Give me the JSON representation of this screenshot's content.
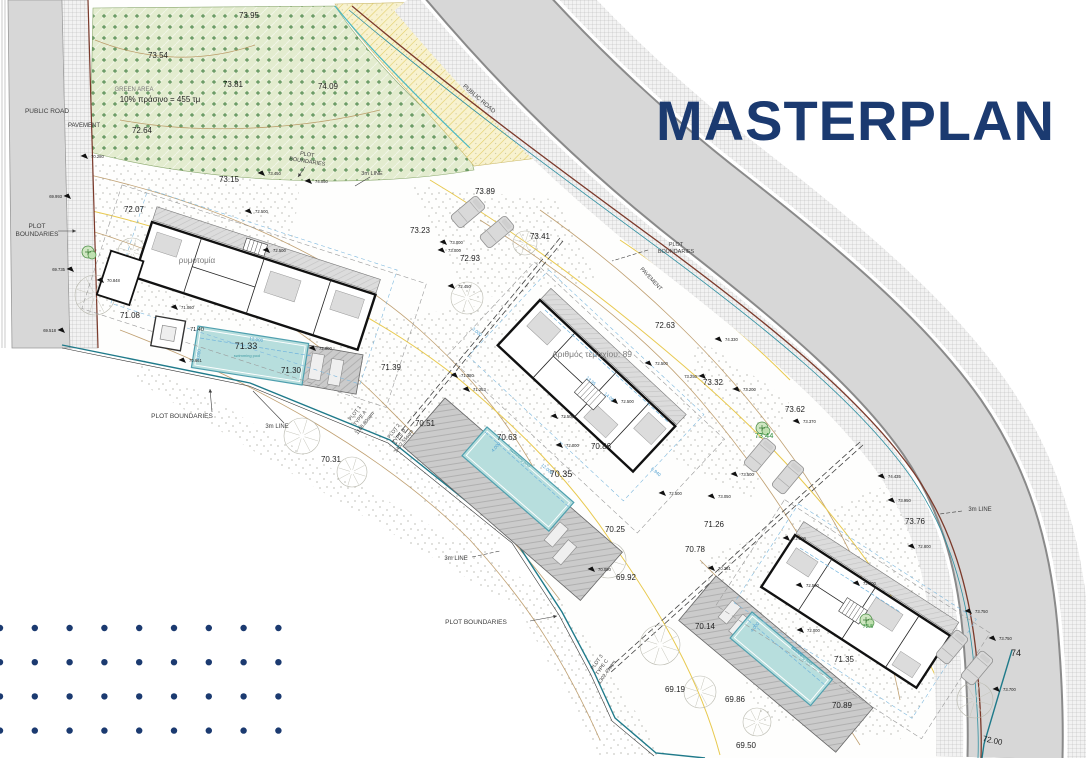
{
  "title": "MASTERPLAN",
  "colors": {
    "accent": "#1b3a70",
    "k": "#1f1f1f",
    "g": "#7a7a7a",
    "c": "#3d3d3d",
    "b": "#4f9fd0",
    "t": "#3f9aa3",
    "gr": "#2f8f3c",
    "pool": "#b7dedd",
    "pool_edge": "#4e9fae",
    "road": "#d7d7d7",
    "boundary_red": "#7b3a2b",
    "boundary_teal": "#2e8fa0",
    "contour_tan": "#b5905a",
    "contour_yellow": "#e8c94f"
  },
  "plan": {
    "labels": [
      {
        "t": "73.95",
        "x": 249,
        "y": 18,
        "s": 8
      },
      {
        "t": "73.54",
        "x": 158,
        "y": 58,
        "s": 8
      },
      {
        "t": "73.81",
        "x": 233,
        "y": 87,
        "s": 8
      },
      {
        "t": "74.09",
        "x": 328,
        "y": 89,
        "s": 8
      },
      {
        "t": "GREEN AREA",
        "x": 134,
        "y": 91,
        "s": 6,
        "c": "g"
      },
      {
        "t": "10% πράσινο = 455 τμ",
        "x": 160,
        "y": 102,
        "s": 8
      },
      {
        "t": "72.64",
        "x": 142,
        "y": 133,
        "s": 8
      },
      {
        "t": "73.15",
        "x": 229,
        "y": 182,
        "s": 8
      },
      {
        "t": "72.07",
        "x": 134,
        "y": 212,
        "s": 8
      },
      {
        "t": "73.89",
        "x": 485,
        "y": 194,
        "s": 8
      },
      {
        "t": "73.23",
        "x": 420,
        "y": 233,
        "s": 8
      },
      {
        "t": "72.93",
        "x": 470,
        "y": 261,
        "s": 8
      },
      {
        "t": "73.41",
        "x": 540,
        "y": 239,
        "s": 8
      },
      {
        "t": "71.08",
        "x": 130,
        "y": 318,
        "s": 8
      },
      {
        "t": "71.33",
        "x": 246,
        "y": 349,
        "s": 9
      },
      {
        "t": "71.30",
        "x": 291,
        "y": 373,
        "s": 8
      },
      {
        "t": "71.39",
        "x": 391,
        "y": 370,
        "s": 8
      },
      {
        "t": "71.40",
        "x": 197,
        "y": 331,
        "s": 5.5
      },
      {
        "t": "70.51",
        "x": 425,
        "y": 426,
        "s": 8
      },
      {
        "t": "70.31",
        "x": 331,
        "y": 462,
        "s": 8
      },
      {
        "t": "70.63",
        "x": 507,
        "y": 440,
        "s": 8
      },
      {
        "t": "70.35",
        "x": 561,
        "y": 477,
        "s": 9
      },
      {
        "t": "70.86",
        "x": 601,
        "y": 449,
        "s": 8
      },
      {
        "t": "70.25",
        "x": 615,
        "y": 532,
        "s": 8
      },
      {
        "t": "72.63",
        "x": 665,
        "y": 328,
        "s": 8
      },
      {
        "t": "73.32",
        "x": 713,
        "y": 385,
        "s": 8
      },
      {
        "t": "73.62",
        "x": 795,
        "y": 412,
        "s": 8
      },
      {
        "t": "73.44",
        "x": 764,
        "y": 438,
        "s": 7.5,
        "c": "gr"
      },
      {
        "t": "72.5",
        "x": 868,
        "y": 628,
        "s": 5.5,
        "c": "gr"
      },
      {
        "t": "71.26",
        "x": 714,
        "y": 527,
        "s": 8
      },
      {
        "t": "70.78",
        "x": 695,
        "y": 552,
        "s": 8
      },
      {
        "t": "69.92",
        "x": 626,
        "y": 580,
        "s": 8
      },
      {
        "t": "70.14",
        "x": 705,
        "y": 629,
        "s": 8
      },
      {
        "t": "69.19",
        "x": 675,
        "y": 692,
        "s": 8
      },
      {
        "t": "69.86",
        "x": 735,
        "y": 702,
        "s": 8
      },
      {
        "t": "69.50",
        "x": 746,
        "y": 748,
        "s": 8
      },
      {
        "t": "73.76",
        "x": 915,
        "y": 524,
        "s": 8
      },
      {
        "t": "71.35",
        "x": 844,
        "y": 662,
        "s": 8
      },
      {
        "t": "70.89",
        "x": 842,
        "y": 708,
        "s": 8
      },
      {
        "t": "74",
        "x": 1016,
        "y": 656,
        "s": 9
      },
      {
        "t": "72.00",
        "x": 992,
        "y": 743,
        "s": 8,
        "r": 12
      },
      {
        "t": "ρυμοτομία",
        "x": 197,
        "y": 263,
        "s": 8,
        "c": "g"
      },
      {
        "t": "Αριθμός τεμαχίου:  89",
        "x": 592,
        "y": 357,
        "s": 8.5,
        "c": "g"
      },
      {
        "t": "PUBLIC ROAD",
        "x": 47,
        "y": 113,
        "s": 6.5,
        "c": "c"
      },
      {
        "t": "PAVEMENT",
        "x": 84,
        "y": 127,
        "s": 6,
        "c": "c"
      },
      {
        "t": "PLOT",
        "x": 37,
        "y": 228,
        "s": 6.5,
        "c": "c"
      },
      {
        "t": "BOUNDARIES",
        "x": 37,
        "y": 236,
        "s": 6.5,
        "c": "c"
      },
      {
        "t": "PUBLIC ROAD",
        "x": 478,
        "y": 100,
        "s": 6,
        "c": "c",
        "r": 41
      },
      {
        "t": "PLOT",
        "x": 676,
        "y": 246,
        "s": 5.5,
        "c": "c"
      },
      {
        "t": "BOUNDARIES",
        "x": 676,
        "y": 253,
        "s": 5.5,
        "c": "c"
      },
      {
        "t": "PAVEMENT",
        "x": 650,
        "y": 280,
        "s": 5.5,
        "c": "c",
        "r": 47
      },
      {
        "t": "3m LINE",
        "x": 372,
        "y": 175,
        "s": 5.5,
        "c": "c"
      },
      {
        "t": "PLOT",
        "x": 307,
        "y": 156,
        "s": 5.5,
        "c": "c",
        "r": 9
      },
      {
        "t": "BOUNDARIES",
        "x": 307,
        "y": 163,
        "s": 5.5,
        "c": "c",
        "r": 9
      },
      {
        "t": "PLOT BOUNDARIES",
        "x": 182,
        "y": 418,
        "s": 6.5,
        "c": "c"
      },
      {
        "t": "3m LINE",
        "x": 277,
        "y": 428,
        "s": 6,
        "c": "c"
      },
      {
        "t": "3m LINE",
        "x": 456,
        "y": 560,
        "s": 6,
        "c": "c"
      },
      {
        "t": "PLOT BOUNDARIES",
        "x": 476,
        "y": 624,
        "s": 6.5,
        "c": "c"
      },
      {
        "t": "3m LINE",
        "x": 980,
        "y": 511,
        "s": 6,
        "c": "c"
      },
      {
        "t": "PLOT 1",
        "x": 356,
        "y": 414,
        "s": 5,
        "c": "c",
        "r": -52
      },
      {
        "t": "TYPE A",
        "x": 361,
        "y": 419,
        "s": 5,
        "c": "c",
        "r": -52
      },
      {
        "t": "1168.80sqm",
        "x": 366,
        "y": 424,
        "s": 5,
        "c": "c",
        "r": -52
      },
      {
        "t": "PLOT 2",
        "x": 395,
        "y": 432,
        "s": 5,
        "c": "c",
        "r": -52
      },
      {
        "t": "TYPE B",
        "x": 400,
        "y": 437,
        "s": 5,
        "c": "c",
        "r": -52
      },
      {
        "t": "1402.55sqm",
        "x": 405,
        "y": 442,
        "s": 5,
        "c": "c",
        "r": -52
      },
      {
        "t": "PLOT 3",
        "x": 598,
        "y": 663,
        "s": 5,
        "c": "c",
        "r": -55
      },
      {
        "t": "TYPE C",
        "x": 603,
        "y": 668,
        "s": 5,
        "c": "c",
        "r": -55
      },
      {
        "t": "1302.45sqm",
        "x": 608,
        "y": 673,
        "s": 5,
        "c": "c",
        "r": -55
      },
      {
        "t": "12.000",
        "x": 256,
        "y": 341,
        "s": 4.5,
        "c": "b",
        "r": 8
      },
      {
        "t": "4.000",
        "x": 200,
        "y": 355,
        "s": 4.5,
        "c": "b",
        "r": -82
      },
      {
        "t": "12.000",
        "x": 546,
        "y": 470,
        "s": 4.5,
        "c": "b",
        "r": 41
      },
      {
        "t": "4.000",
        "x": 497,
        "y": 448,
        "s": 4.5,
        "c": "b",
        "r": -49
      },
      {
        "t": "12.000",
        "x": 796,
        "y": 652,
        "s": 4.5,
        "c": "b",
        "r": 40
      },
      {
        "t": "4.000",
        "x": 756,
        "y": 628,
        "s": 4.5,
        "c": "b",
        "r": -50
      },
      {
        "t": "13.95",
        "x": 590,
        "y": 382,
        "s": 4.5,
        "c": "b",
        "r": 41
      },
      {
        "t": "14.05",
        "x": 608,
        "y": 398,
        "s": 4.5,
        "c": "b",
        "r": 41
      },
      {
        "t": "6.940",
        "x": 655,
        "y": 473,
        "s": 4.5,
        "c": "b",
        "r": 41
      },
      {
        "t": "3.000",
        "x": 476,
        "y": 333,
        "s": 4.5,
        "c": "b",
        "r": 41
      },
      {
        "t": "swimming pool",
        "x": 247,
        "y": 357,
        "s": 4,
        "c": "t"
      },
      {
        "t": "swimming pool",
        "x": 519,
        "y": 459,
        "s": 4,
        "c": "t",
        "r": 41
      },
      {
        "t": "swimming pool",
        "x": 801,
        "y": 657,
        "s": 4,
        "c": "t",
        "r": 40
      }
    ],
    "spot_levels": [
      {
        "v": "70.280",
        "x": 88,
        "y": 159
      },
      {
        "v": "73.450",
        "x": 265,
        "y": 176
      },
      {
        "v": "74.050",
        "x": 312,
        "y": 184
      },
      {
        "v": "72.500",
        "x": 252,
        "y": 214
      },
      {
        "v": "72.500",
        "x": 270,
        "y": 253
      },
      {
        "v": "71.060",
        "x": 178,
        "y": 310
      },
      {
        "v": "69.993",
        "x": 71,
        "y": 199,
        "side": "l"
      },
      {
        "v": "69.735",
        "x": 74,
        "y": 272,
        "side": "l"
      },
      {
        "v": "70.848",
        "x": 104,
        "y": 283
      },
      {
        "v": "69.518",
        "x": 65,
        "y": 333,
        "side": "l"
      },
      {
        "v": "70.661",
        "x": 186,
        "y": 363
      },
      {
        "v": "72.000",
        "x": 316,
        "y": 351
      },
      {
        "v": "71.380",
        "x": 458,
        "y": 378
      },
      {
        "v": "71.253",
        "x": 470,
        "y": 392
      },
      {
        "v": "73.000",
        "x": 447,
        "y": 245
      },
      {
        "v": "73.000",
        "x": 445,
        "y": 253
      },
      {
        "v": "72.450",
        "x": 455,
        "y": 289
      },
      {
        "v": "72.500",
        "x": 652,
        "y": 366
      },
      {
        "v": "72.500",
        "x": 618,
        "y": 404
      },
      {
        "v": "72.500",
        "x": 558,
        "y": 419
      },
      {
        "v": "72.000",
        "x": 563,
        "y": 448
      },
      {
        "v": "72.500",
        "x": 666,
        "y": 496
      },
      {
        "v": "73.050",
        "x": 715,
        "y": 499
      },
      {
        "v": "70.090",
        "x": 595,
        "y": 572
      },
      {
        "v": "70.281",
        "x": 715,
        "y": 571
      },
      {
        "v": "72.500",
        "x": 790,
        "y": 541
      },
      {
        "v": "72.500",
        "x": 803,
        "y": 588
      },
      {
        "v": "72.500",
        "x": 860,
        "y": 586
      },
      {
        "v": "72.800",
        "x": 915,
        "y": 549
      },
      {
        "v": "73.950",
        "x": 895,
        "y": 503
      },
      {
        "v": "74.435",
        "x": 885,
        "y": 479
      },
      {
        "v": "74.330",
        "x": 722,
        "y": 342
      },
      {
        "v": "73.250",
        "x": 706,
        "y": 379,
        "side": "l"
      },
      {
        "v": "73.200",
        "x": 740,
        "y": 392
      },
      {
        "v": "73.370",
        "x": 800,
        "y": 424
      },
      {
        "v": "73.500",
        "x": 738,
        "y": 477
      },
      {
        "v": "73.750",
        "x": 972,
        "y": 614
      },
      {
        "v": "73.750",
        "x": 996,
        "y": 641
      },
      {
        "v": "73.700",
        "x": 1000,
        "y": 692
      },
      {
        "v": "72.000",
        "x": 804,
        "y": 633
      }
    ],
    "trees": [
      {
        "x": 95,
        "y": 295,
        "r": 20
      },
      {
        "x": 132,
        "y": 252,
        "r": 14
      },
      {
        "x": 302,
        "y": 436,
        "r": 18
      },
      {
        "x": 352,
        "y": 472,
        "r": 15
      },
      {
        "x": 467,
        "y": 298,
        "r": 16
      },
      {
        "x": 525,
        "y": 243,
        "r": 12
      },
      {
        "x": 560,
        "y": 525,
        "r": 16
      },
      {
        "x": 608,
        "y": 560,
        "r": 18
      },
      {
        "x": 660,
        "y": 645,
        "r": 20
      },
      {
        "x": 700,
        "y": 692,
        "r": 16
      },
      {
        "x": 757,
        "y": 722,
        "r": 14
      },
      {
        "x": 975,
        "y": 700,
        "r": 18
      }
    ],
    "green_trees": [
      {
        "x": 88,
        "y": 252
      },
      {
        "x": 762,
        "y": 428
      },
      {
        "x": 866,
        "y": 620
      }
    ],
    "cars": [
      {
        "x": 468,
        "y": 212,
        "r": 50
      },
      {
        "x": 497,
        "y": 232,
        "r": 50
      },
      {
        "x": 760,
        "y": 455,
        "r": 40
      },
      {
        "x": 788,
        "y": 477,
        "r": 40
      },
      {
        "x": 952,
        "y": 647,
        "r": 40
      },
      {
        "x": 977,
        "y": 668,
        "r": 40
      }
    ]
  },
  "decor_dots": {
    "cols": 9,
    "rows": 4,
    "x0": 0,
    "y0": 628,
    "dx": 34.8,
    "dy": 34.2,
    "radius": 3.2
  }
}
